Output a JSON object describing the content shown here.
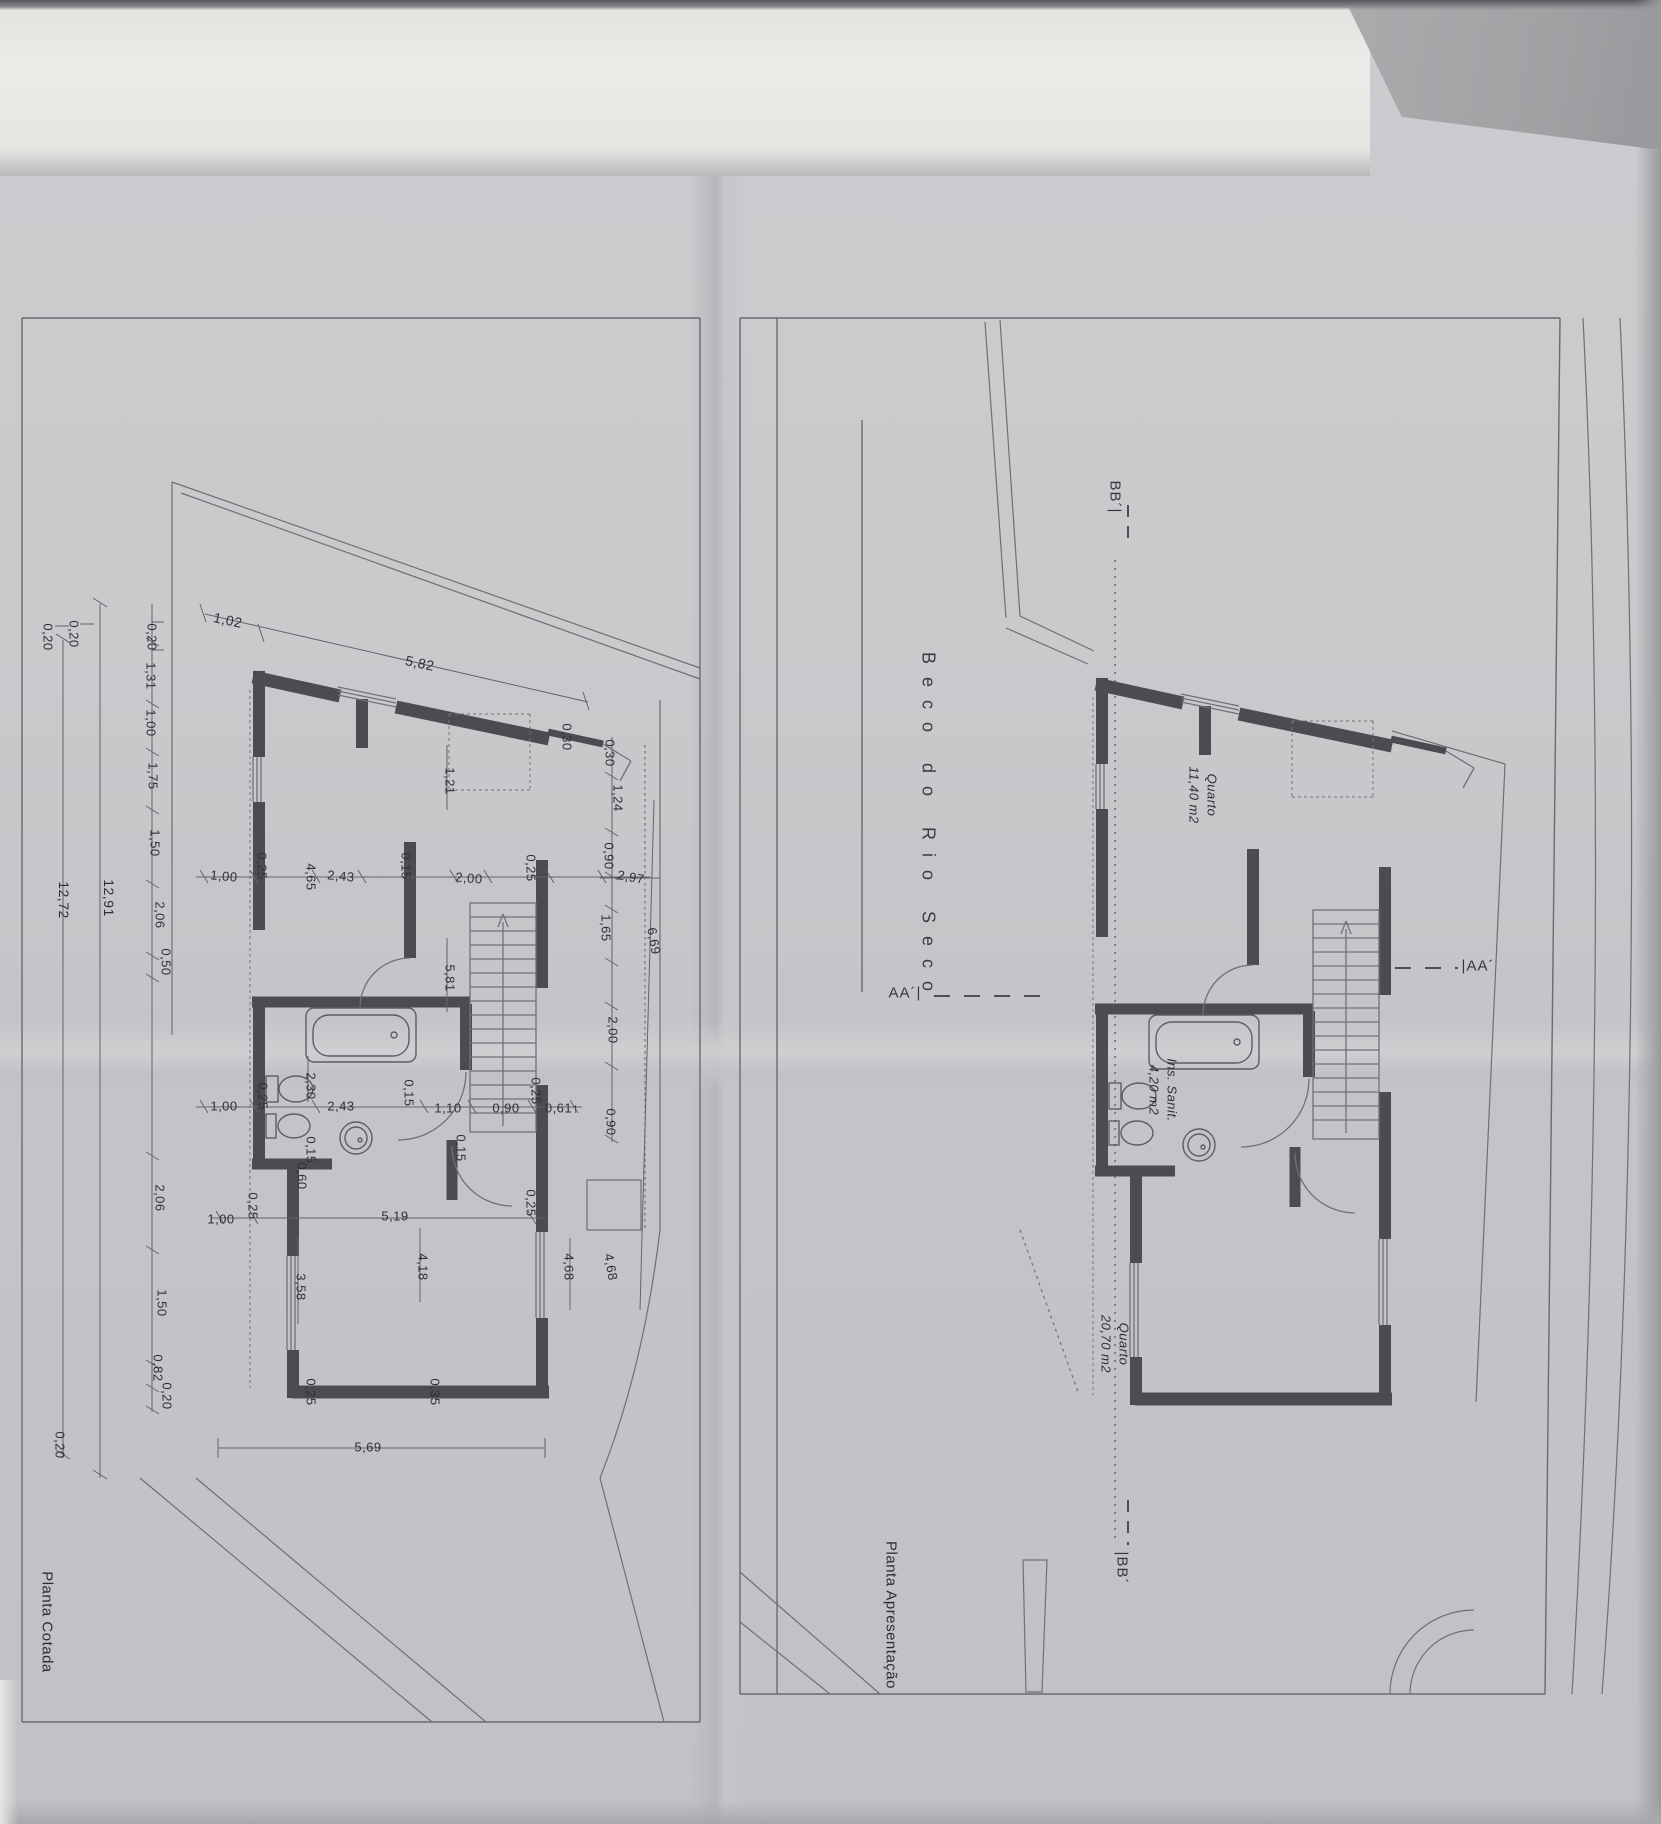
{
  "page": {
    "street_label": "Beco do Rio Seco"
  },
  "left_plan": {
    "title": "Planta Cotada",
    "labels": [
      "0,20",
      "0,20",
      "12,72",
      "12,91",
      "0,20",
      "1,31",
      "1,00",
      "1,75",
      "1,50",
      "2,06",
      "0,50",
      "2,06",
      "1,50",
      "0,82",
      "0,20",
      "0,20",
      "1,02",
      "5,82",
      "0,30",
      "0,30",
      "1,24",
      "1,21",
      "0,90",
      "2,97",
      "1,65",
      "6,69",
      "1,00",
      "0,25",
      "4,65",
      "2,43",
      "0,15",
      "2,00",
      "0,25",
      "5,81",
      "2,00",
      "0,90",
      "1,00",
      "0,25",
      "2,30",
      "2,43",
      "0,15",
      "1,10",
      "0,90",
      "0,25",
      "0,61↑",
      "0,15",
      "0,15",
      "0,60",
      "0,25",
      "1,00",
      "5,19",
      "0,25",
      "3,58",
      "4,18",
      "4,68",
      "4,68",
      "0,25",
      "0,35",
      "5,69"
    ]
  },
  "right_plan": {
    "title": "Planta Apresentação",
    "markers": {
      "bb_top": "BB´|",
      "aa_left": "AA´|",
      "aa_right": "|AA´",
      "bb_bottom": "|BB´"
    },
    "rooms": [
      {
        "name": "Quarto",
        "area": "11,40 m2"
      },
      {
        "name": "Ins. Sanit.",
        "area": "4,20 m2"
      },
      {
        "name": "Quarto",
        "area": "20,70 m2"
      }
    ]
  }
}
